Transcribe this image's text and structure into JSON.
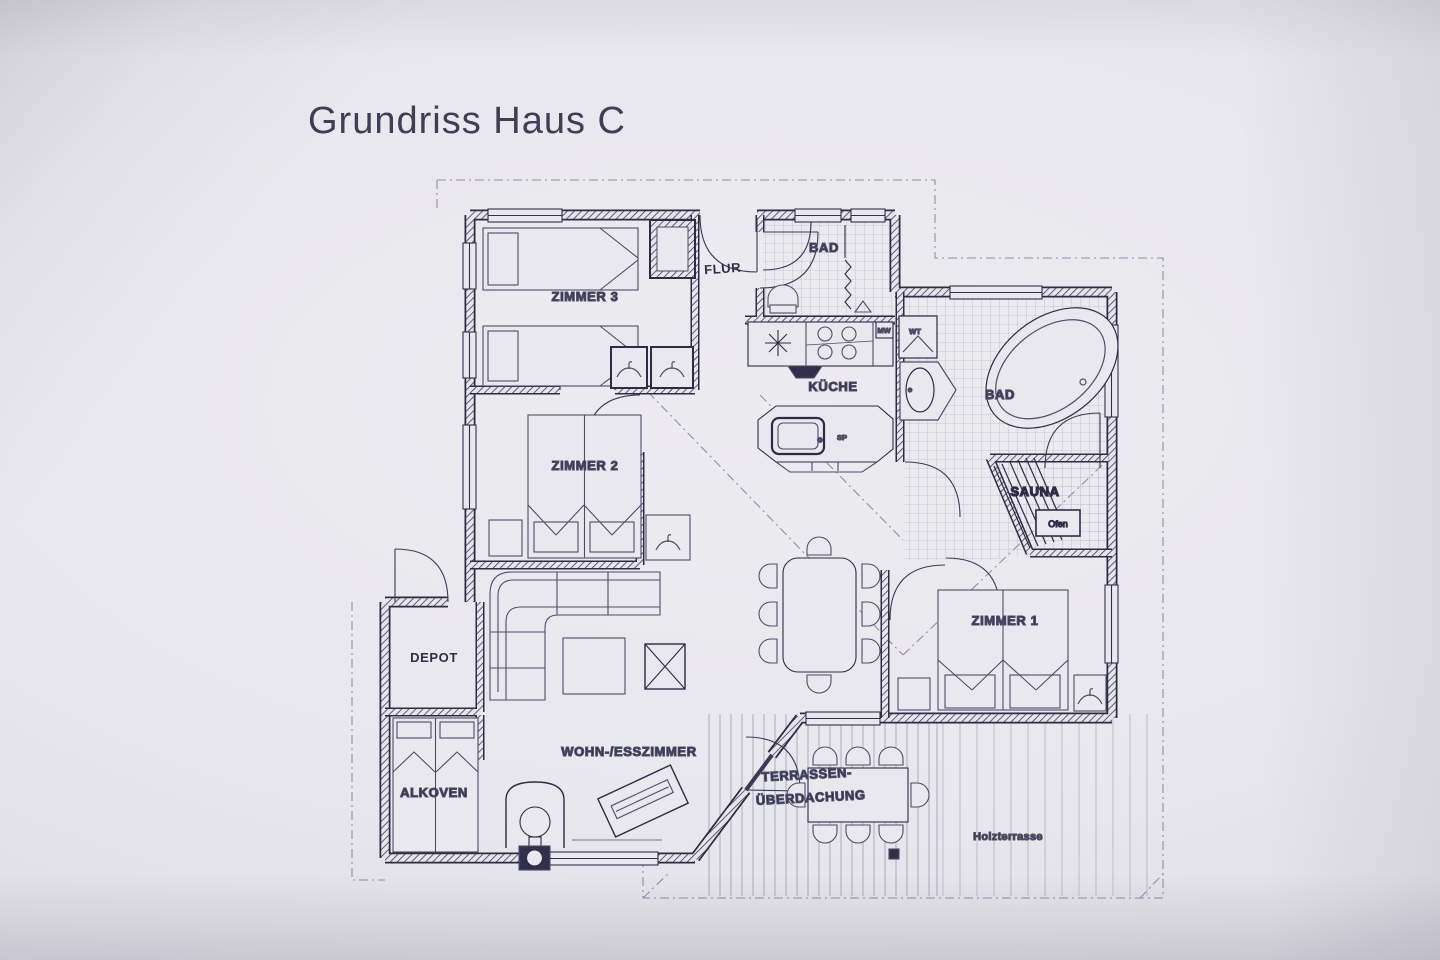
{
  "title": "Grundriss Haus C",
  "plan": {
    "rooms": {
      "zimmer3": "ZIMMER 3",
      "zimmer2": "ZIMMER 2",
      "zimmer1": "ZIMMER 1",
      "flur": "FLUR",
      "bad_top": "BAD",
      "bad_right": "BAD",
      "kueche": "KÜCHE",
      "sauna": "SAUNA",
      "depot": "DEPOT",
      "alkoven": "ALKOVEN",
      "wohnzimmer": "WOHN-/ESSZIMMER",
      "terrasse_line1": "TERRASSEN-",
      "terrasse_line2": "ÜBERDACHUNG",
      "holzterrasse": "Holzterrasse"
    },
    "appliances": {
      "ofen": "Ofen",
      "mw": "MW",
      "wt": "WT",
      "sp": "SP"
    },
    "colors": {
      "ink": "#30304a",
      "furniture": "#4d4d68",
      "paper": "#e9e8ee"
    }
  }
}
